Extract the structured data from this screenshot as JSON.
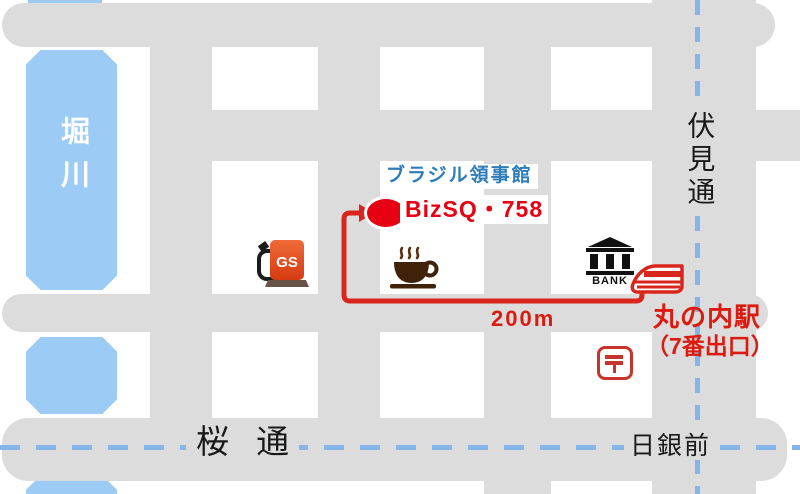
{
  "colors": {
    "road_gray": "#dcdcdc",
    "river_blue": "#9ccbf6",
    "dashed_line_blue": "#85b5e8",
    "accent_red": "#e60012",
    "route_red": "#d8261c",
    "consulate_blue": "#2e7cb8",
    "text_black": "#1a1a1a",
    "coffee_brown": "#402209",
    "gs_orange": "#d63b12"
  },
  "streets": {
    "horikawa_river": "堀川",
    "fushimi_dori": "伏見通",
    "sakura_dori": "桜 通",
    "nichigin_mae": "日銀前"
  },
  "destination": {
    "consulate": "ブラジル領事館",
    "venue": "BizSQ・758"
  },
  "route": {
    "distance": "200m",
    "station_name": "丸の内駅",
    "station_exit": "（7番出口）"
  },
  "landmarks": {
    "gas_station": "GS",
    "bank": "BANK",
    "post_office_mark": "〒",
    "cafe_icon": "coffee-cup-icon",
    "train_icon": "train-icon"
  }
}
